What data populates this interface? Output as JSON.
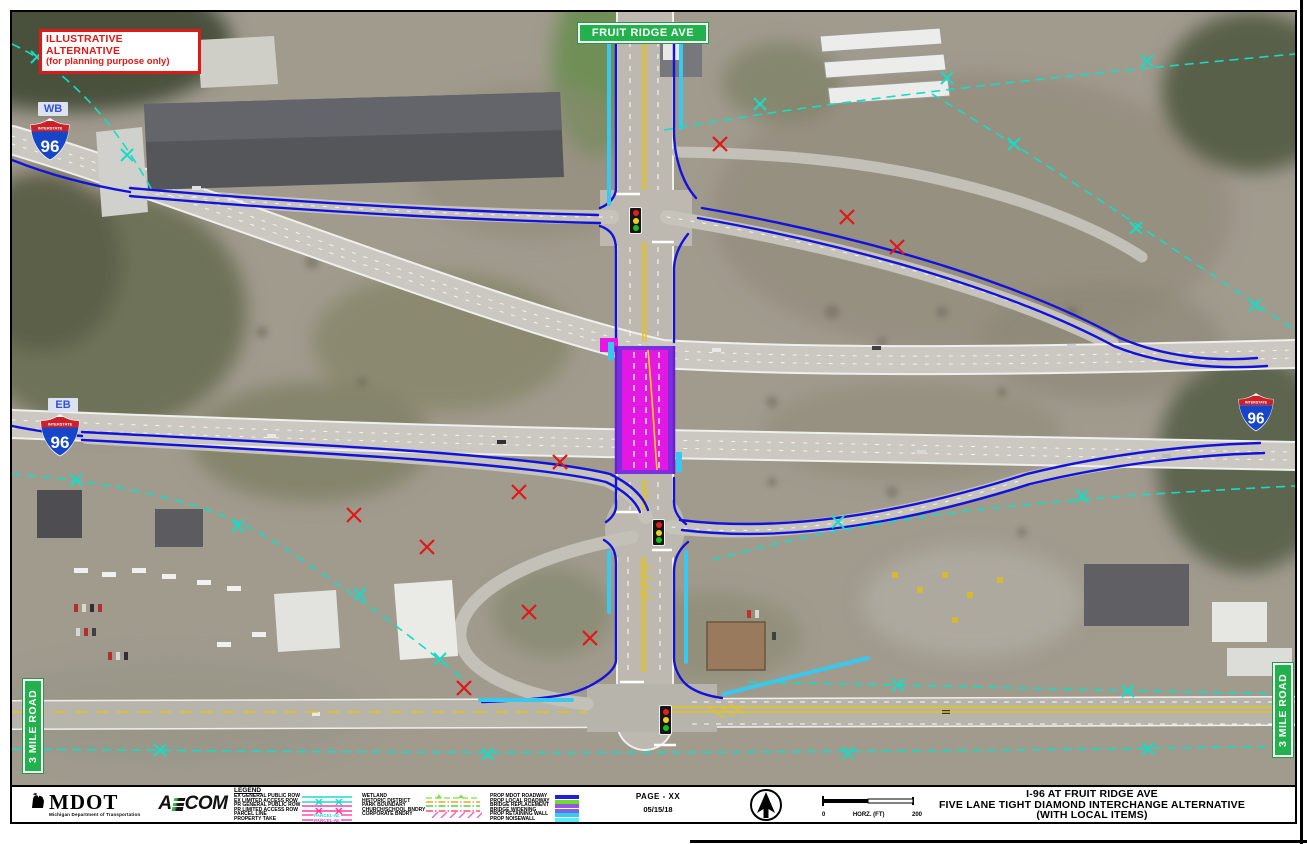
{
  "warning": {
    "line1": "ILLUSTRATIVE ALTERNATIVE",
    "line2": "(for planning  purpose only)"
  },
  "map": {
    "fruit_ridge_ave": "FRUIT RIDGE AVE",
    "three_mile_road_left": "3 MILE ROAD",
    "three_mile_road_right": "3 MILE ROAD",
    "wb": "WB",
    "eb": "EB",
    "interstate": "INTERSTATE",
    "route_number": "96"
  },
  "footer": {
    "mdot": {
      "name": "MDOT",
      "tagline": "Michigan Department of Transportation"
    },
    "aecom": {
      "prefix": "A",
      "suffix": "COM"
    },
    "legend": {
      "title": "LEGEND",
      "group1": [
        {
          "label": "EX GENERAL PUBLIC ROW",
          "symbol": "line",
          "color": "#1ddbd0"
        },
        {
          "label": "EX LIMITED ACCESS ROW",
          "symbol": "line-x",
          "color": "#1ddbd0"
        },
        {
          "label": "PR GENERAL PUBLIC ROW",
          "symbol": "line",
          "color": "#ff3ea5"
        },
        {
          "label": "PR LIMITED ACCESS ROW",
          "symbol": "line-x",
          "color": "#ff3ea5"
        },
        {
          "label": "PARCEL LINE",
          "symbol": "line-label",
          "color": "#ff3ea5",
          "text": "PARCEL-NL",
          "text_color": "#1ddbd0"
        },
        {
          "label": "PROPERTY TAKE",
          "symbol": "line-label",
          "color": "#ff3ea5",
          "text": "PARCEL-NL",
          "text_color": "#ff2fd0"
        }
      ],
      "group2": [
        {
          "label": "WETLAND",
          "symbol": "dash-tri",
          "color": "#7ae042"
        },
        {
          "label": "HISTORIC DISTRICT",
          "symbol": "dash-dot",
          "color": "#ffa020"
        },
        {
          "label": "PARK BOUNDARY",
          "symbol": "dash-dot",
          "color": "#4fd04f"
        },
        {
          "label": "CHURCH/SCHOOL BNDRY",
          "symbol": "dash-dot",
          "color": "#ff5560"
        },
        {
          "label": "CORPORATE BNDRY",
          "symbol": "hatch",
          "color": "#ff5ad0"
        }
      ],
      "group3": [
        {
          "label": "PROP MDOT ROADWAY",
          "symbol": "swatch",
          "color": "#2020d8"
        },
        {
          "label": "PROP LOCAL ROADWAY",
          "symbol": "swatch",
          "color": "#6fdc2e"
        },
        {
          "label": "BRIDGE REPLACEMENT",
          "symbol": "swatch",
          "color": "#9a55e0"
        },
        {
          "label": "BRIDGE WIDENING",
          "symbol": "swatch",
          "color": "#7a66e6"
        },
        {
          "label": "PROP RETAINING WALL",
          "symbol": "swatch",
          "color": "#2fd0e8"
        },
        {
          "label": "PROP NOISEWALL",
          "symbol": "swatch",
          "color": "#5ceaff"
        }
      ]
    },
    "page": {
      "label": "PAGE - XX",
      "date": "05/15/18"
    },
    "scale": {
      "start": "0",
      "unit": "HORZ. (FT)",
      "end": "200"
    },
    "title_block": [
      "I-96 AT FRUIT RIDGE AVE",
      "FIVE LANE TIGHT DIAMOND INTERCHANGE ALTERNATIVE",
      "(WITH LOCAL ITEMS)"
    ]
  },
  "colors": {
    "prop_mdot_roadway": "#1212dc",
    "prop_local_roadway": "#6fdc2e",
    "bridge_replacement": "#e318e3",
    "bridge_widening": "#7d2fe0",
    "prop_retaining_wall": "#38c8f0",
    "ex_row_teal": "#15dcc6",
    "property_take_red": "#e01818",
    "road_label_green": "#23b14d",
    "warning_red": "#e01818"
  }
}
